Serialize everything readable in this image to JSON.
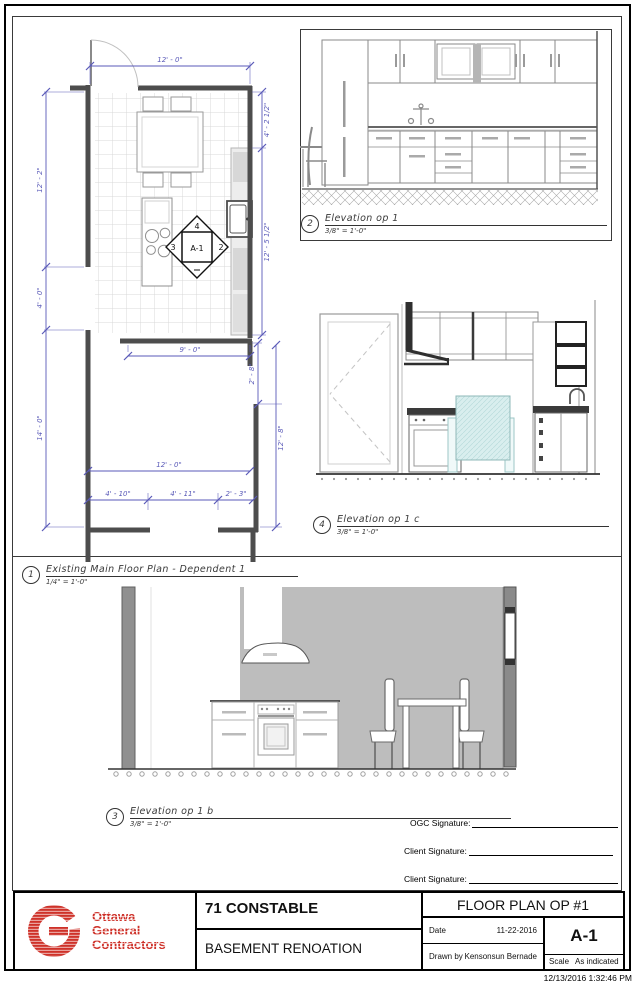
{
  "colors": {
    "dimension_blue": "#5a5ab8",
    "wall_line": "#4d4d4d",
    "elevation_wall_grey": "#bdbdbd",
    "logo_red": "#ce3129",
    "table_cyan": "#d9eeee"
  },
  "views": {
    "floor_plan": {
      "number": "1",
      "title": "Existing Main Floor Plan - Dependent 1",
      "scale": "1/4\" = 1'-0\""
    },
    "elevation_1": {
      "number": "2",
      "title": "Elevation op 1",
      "scale": "3/8\" = 1'-0\""
    },
    "elevation_1c": {
      "number": "4",
      "title": "Elevation op 1 c",
      "scale": "3/8\" = 1'-0\""
    },
    "elevation_1b": {
      "number": "3",
      "title": "Elevation op 1 b",
      "scale": "3/8\" = 1'-0\""
    }
  },
  "floor_plan": {
    "dims": {
      "top_width": "12' - 0\"",
      "left_upper": "12' - 2\"",
      "left_opening": "4' - 0\"",
      "left_lower": "14' - 0\"",
      "right_upper": "4' - 2 1/2\"",
      "right_mid": "12' - 5 1/2\"",
      "right_jog": "2' - 8\"",
      "right_lower": "12' - 8\"",
      "inner_opening": "9' - 0\"",
      "lower_width": "12' - 0\"",
      "bottom_a": "4' - 10\"",
      "bottom_b": "4' - 11\"",
      "bottom_c": "2' - 3\""
    },
    "marker": {
      "sheet": "A-1",
      "top": "4",
      "left": "3",
      "right": "2"
    }
  },
  "signatures": {
    "ogc": "OGC Signature:",
    "client1": "Client Signature:",
    "client2": "Client Signature:"
  },
  "title_block": {
    "logo": {
      "line1": "Ottawa",
      "line2": "General",
      "line3": "Contractors"
    },
    "project": "71 CONSTABLE",
    "project_subtitle": "BASEMENT RENOATION",
    "sheet_title": "FLOOR PLAN OP #1",
    "date_label": "Date",
    "date": "11-22-2016",
    "drawn_by_label": "Drawn by",
    "drawn_by": "Kensonsun Bernade",
    "sheet_number": "A-1",
    "scale_label": "Scale",
    "scale_value": "As indicated"
  },
  "footer": {
    "timestamp": "12/13/2016 1:32:46 PM"
  }
}
